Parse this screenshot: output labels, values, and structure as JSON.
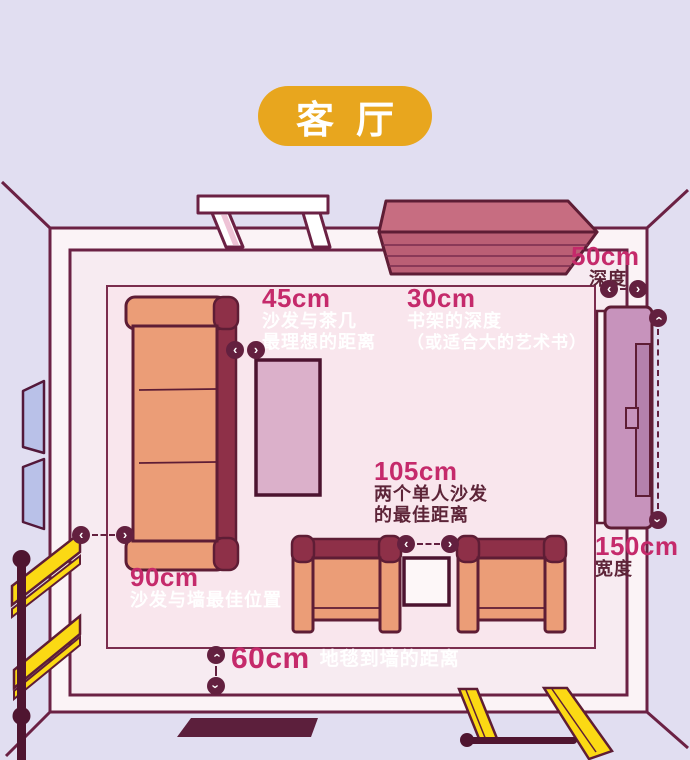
{
  "title": {
    "badge": "客厅"
  },
  "annotations": [
    {
      "id": "sofa-coffee-table",
      "value": "45cm",
      "lines": [
        "沙发与茶几",
        "最理想的距离"
      ]
    },
    {
      "id": "bookshelf-depth",
      "value": "30cm",
      "lines": [
        "书架的深度",
        "（或适合大的艺术书）"
      ]
    },
    {
      "id": "two-single-sofas",
      "value": "105cm",
      "lines": [
        "两个单人沙发",
        "的最佳距离"
      ]
    },
    {
      "id": "sofa-wall",
      "value": "90cm",
      "lines": [
        "沙发与墙最佳位置"
      ]
    },
    {
      "id": "carpet-wall",
      "value": "60cm",
      "lines": [
        "地毯到墙的距离"
      ]
    },
    {
      "id": "cabinet-depth",
      "value": "50cm",
      "lines": [
        "深度"
      ]
    },
    {
      "id": "cabinet-width",
      "value": "150cm",
      "lines": [
        "宽度"
      ]
    }
  ],
  "furniture": [
    "three-seat-sofa",
    "coffee-table",
    "armchair-left",
    "armchair-right",
    "side-table",
    "wall-bookshelf",
    "display-cabinet",
    "door",
    "window",
    "stair-railing",
    "ladder",
    "floor-mat",
    "carpet"
  ],
  "colors": {
    "background": "#e1def1",
    "floor": "#f7ebf1",
    "carpet": "#f9e6ed",
    "wall_fill": "#fbf3f6",
    "outline": "#6b2144",
    "accent_gold": "#e8a61e",
    "number_magenta": "#c52a6b",
    "label_white": "#ffffff",
    "label_dark": "#5d2438",
    "sofa_salmon": "#eb9d77",
    "sofa_maroon": "#8e3048",
    "coffee_table_mauve": "#dbb0ca",
    "cabinet_mauve": "#c793bc",
    "bookshelf_rose": "#c76d81",
    "railing_yellow": "#fbd914",
    "window_blue": "#b9c1e8"
  }
}
